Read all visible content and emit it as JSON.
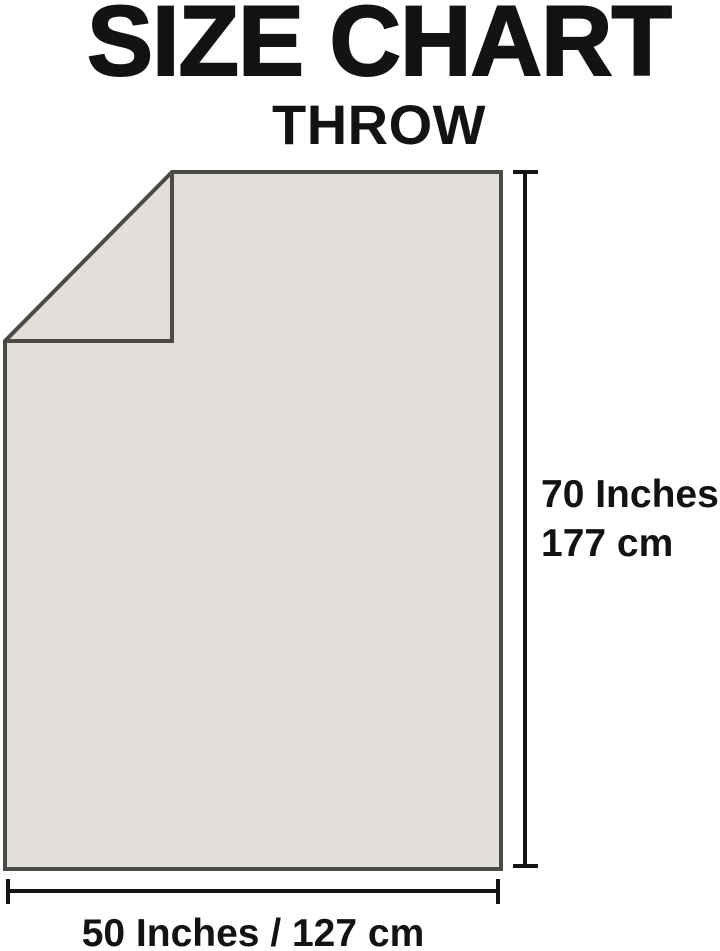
{
  "header": {
    "title": "SIZE CHART",
    "subtitle": "THROW"
  },
  "diagram": {
    "product": "throw-blanket-with-folded-corner",
    "height_dimension": {
      "inches": "70 Inches",
      "centimeters": "177 cm"
    },
    "width_dimension": {
      "label": "50 Inches / 127 cm"
    }
  },
  "colors": {
    "background": "#ffffff",
    "text_color": "#131313",
    "line_color": "#141414",
    "blanket_fill": "#e2dfda",
    "blanket_outline": "#4b4a47"
  }
}
